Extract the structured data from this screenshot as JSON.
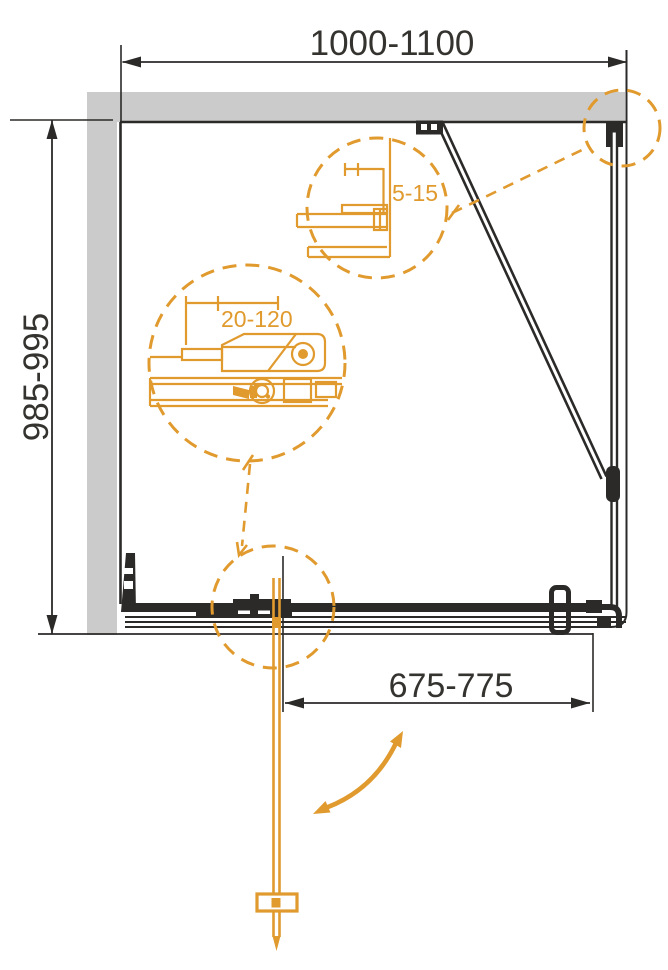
{
  "drawing": {
    "title": "shower-enclosure-installation-plan",
    "dimensions": {
      "top_width": "1000-1100",
      "left_height": "985-995",
      "bottom_door_width": "675-775",
      "detail_wall_profile_adjustment": "5-15",
      "detail_bracket_adjustment": "20-120"
    },
    "colors": {
      "line": "#2b2a29",
      "dim_text": "#35332f",
      "accent": "#e09a2e",
      "wall_fill": "#cbcbcb"
    }
  }
}
